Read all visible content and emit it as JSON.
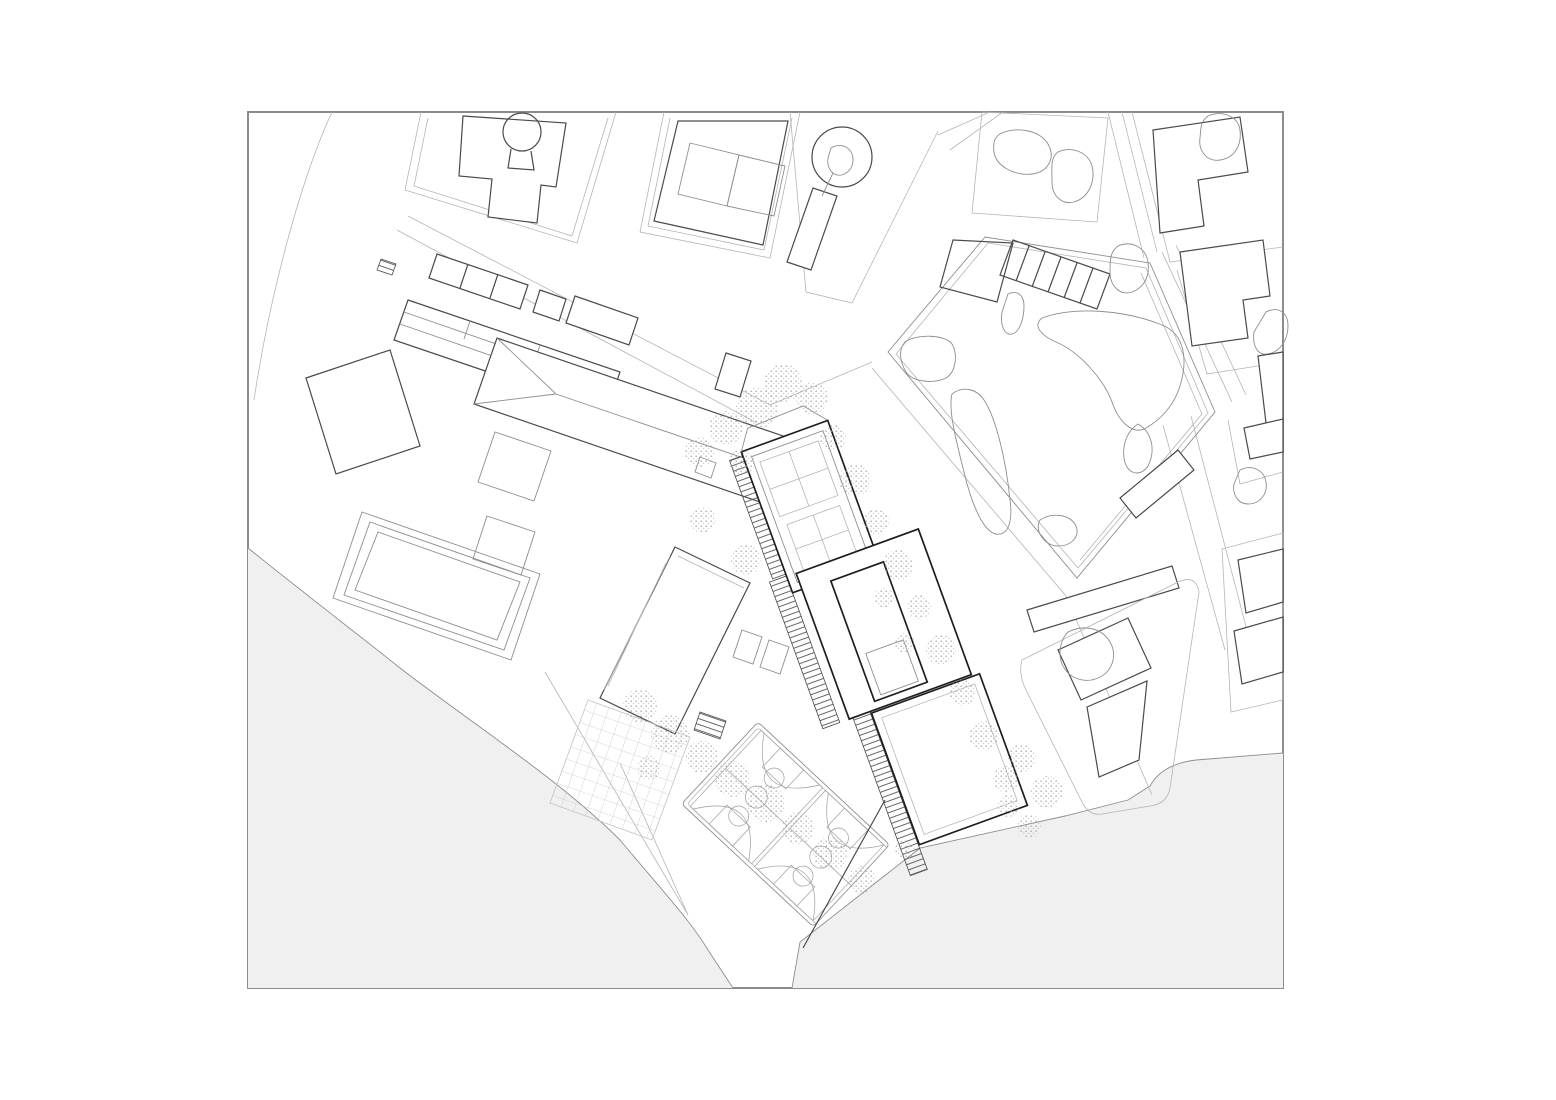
{
  "meta": {
    "drawing_type": "architectural site plan",
    "style": "black and white line drawing, no text labels visible",
    "sheet": {
      "width_px": 1556,
      "height_px": 1100
    },
    "frame": {
      "x": 248,
      "y": 112,
      "width": 1035,
      "height": 876
    }
  },
  "palette": {
    "paper": "#ffffff",
    "water": "#f0f0f0",
    "ink": "#1e1e1e",
    "dark": "#4a4a4a",
    "mid": "#8e8e8e",
    "light": "#b5b5b5",
    "faint": "#cfcfcf",
    "stipple": "#9b9b9b"
  },
  "features": [
    "drawing-frame",
    "waterfront-grey-area-southwest",
    "grey-area-southeast",
    "existing-city-blocks-north",
    "keyhole-courtyard-building",
    "p-shaped-building",
    "pentagonal-park-with-landscape-blobs",
    "school-campus-west",
    "hip-roof-building",
    "new-building-complex-with-stair-ramps",
    "two-basketball-courts",
    "gridded-paving-plaza",
    "street-tree-rows"
  ],
  "counts": {
    "basketball_courts": 2,
    "stair_ramps": 4,
    "park_blobs": 7
  },
  "trees": [
    {
      "x": 812,
      "y": 398,
      "r": 16
    },
    {
      "x": 833,
      "y": 438,
      "r": 13
    },
    {
      "x": 855,
      "y": 480,
      "r": 16
    },
    {
      "x": 876,
      "y": 522,
      "r": 13
    },
    {
      "x": 898,
      "y": 565,
      "r": 15
    },
    {
      "x": 919,
      "y": 607,
      "r": 12
    },
    {
      "x": 941,
      "y": 650,
      "r": 15
    },
    {
      "x": 962,
      "y": 693,
      "r": 13
    },
    {
      "x": 984,
      "y": 736,
      "r": 15
    },
    {
      "x": 1006,
      "y": 779,
      "r": 13
    },
    {
      "x": 783,
      "y": 383,
      "r": 19
    },
    {
      "x": 757,
      "y": 408,
      "r": 21
    },
    {
      "x": 726,
      "y": 428,
      "r": 17
    },
    {
      "x": 700,
      "y": 452,
      "r": 15
    },
    {
      "x": 742,
      "y": 462,
      "r": 13
    },
    {
      "x": 703,
      "y": 520,
      "r": 13
    },
    {
      "x": 746,
      "y": 560,
      "r": 15
    },
    {
      "x": 640,
      "y": 706,
      "r": 17
    },
    {
      "x": 670,
      "y": 734,
      "r": 19
    },
    {
      "x": 702,
      "y": 757,
      "r": 16
    },
    {
      "x": 649,
      "y": 768,
      "r": 12
    },
    {
      "x": 733,
      "y": 779,
      "r": 18
    },
    {
      "x": 766,
      "y": 803,
      "r": 19
    },
    {
      "x": 798,
      "y": 828,
      "r": 16
    },
    {
      "x": 830,
      "y": 854,
      "r": 17
    },
    {
      "x": 862,
      "y": 880,
      "r": 14
    },
    {
      "x": 905,
      "y": 850,
      "r": 10
    },
    {
      "x": 1022,
      "y": 758,
      "r": 14
    },
    {
      "x": 1047,
      "y": 792,
      "r": 16
    },
    {
      "x": 1029,
      "y": 826,
      "r": 12
    },
    {
      "x": 1008,
      "y": 806,
      "r": 11
    },
    {
      "x": 884,
      "y": 598,
      "r": 10
    },
    {
      "x": 905,
      "y": 643,
      "r": 10
    }
  ]
}
